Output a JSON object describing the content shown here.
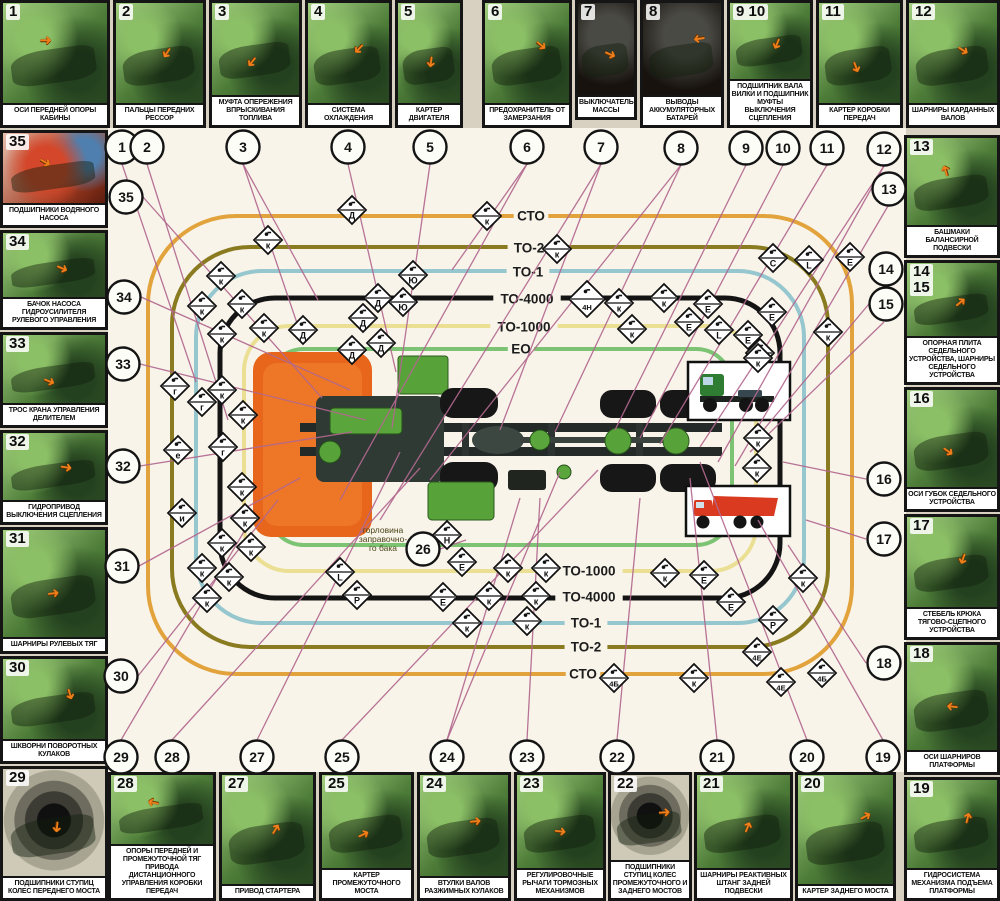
{
  "chart_title": "",
  "colors": {
    "page_bg": "#d8d0c0",
    "field_bg": "#f8f4ea",
    "line": "#b2688e",
    "ring_sto": "#e2a33c",
    "ring_to2": "#8a7b20",
    "ring_to1": "#96c6ce",
    "ring_to4000": "#141414",
    "ring_to1000": "#eadf92",
    "ring_eo": "#7cc474",
    "cab_orange": "#e8661c",
    "part_green": "#57a33a",
    "arrow_orange": "#ef7f1a"
  },
  "panels": {
    "top": [
      {
        "n": "1",
        "x": 0,
        "y": 0,
        "w": 110,
        "h": 128,
        "cap": "ОСИ ПЕРЕДНЕЙ ОПОРЫ КАБИНЫ",
        "v": "green"
      },
      {
        "n": "2",
        "x": 113,
        "y": 0,
        "w": 93,
        "h": 128,
        "cap": "ПАЛЬЦЫ ПЕРЕДНИХ РЕССОР",
        "v": "green"
      },
      {
        "n": "3",
        "x": 209,
        "y": 0,
        "w": 93,
        "h": 128,
        "cap": "МУФТА ОПЕРЕЖЕНИЯ ВПРЫСКИВАНИЯ ТОПЛИВА",
        "v": "green"
      },
      {
        "n": "4",
        "x": 305,
        "y": 0,
        "w": 87,
        "h": 128,
        "cap": "СИСТЕМА ОХЛАЖДЕНИЯ",
        "v": "green"
      },
      {
        "n": "5",
        "x": 395,
        "y": 0,
        "w": 68,
        "h": 128,
        "cap": "КАРТЕР ДВИГАТЕЛЯ",
        "v": "green"
      },
      {
        "n": "6",
        "x": 482,
        "y": 0,
        "w": 90,
        "h": 128,
        "cap": "ПРЕДОХРАНИТЕЛЬ ОТ ЗАМЕРЗАНИЯ",
        "v": "green"
      },
      {
        "n": "7",
        "x": 575,
        "y": 0,
        "w": 62,
        "h": 120,
        "cap": "ВЫКЛЮЧАТЕЛЬ МАССЫ",
        "v": "dark"
      },
      {
        "n": "8",
        "x": 640,
        "y": 0,
        "w": 84,
        "h": 128,
        "cap": "ВЫВОДЫ АККУМУЛЯТОРНЫХ БАТАРЕЙ",
        "v": "dark"
      },
      {
        "n": "9 10",
        "x": 727,
        "y": 0,
        "w": 86,
        "h": 128,
        "cap": "ПОДШИПНИК ВАЛА ВИЛКИ И ПОДШИПНИК МУФТЫ ВЫКЛЮЧЕНИЯ СЦЕПЛЕНИЯ",
        "v": "green"
      },
      {
        "n": "11",
        "x": 816,
        "y": 0,
        "w": 87,
        "h": 128,
        "cap": "КАРТЕР КОРОБКИ ПЕРЕДАЧ",
        "v": "green"
      },
      {
        "n": "12",
        "x": 906,
        "y": 0,
        "w": 94,
        "h": 128,
        "cap": "ШАРНИРЫ КАРДАННЫХ ВАЛОВ",
        "v": "green"
      }
    ],
    "left": [
      {
        "n": "35",
        "x": 0,
        "y": 130,
        "w": 108,
        "h": 98,
        "cap": "ПОДШИПНИКИ ВОДЯНОГО НАСОСА",
        "v": "red"
      },
      {
        "n": "34",
        "x": 0,
        "y": 230,
        "w": 108,
        "h": 100,
        "cap": "БАЧОК НАСОСА ГИДРОУСИЛИТЕЛЯ РУЛЕВОГО УПРАВЛЕНИЯ",
        "v": "green"
      },
      {
        "n": "33",
        "x": 0,
        "y": 332,
        "w": 108,
        "h": 96,
        "cap": "ТРОС КРАНА УПРАВЛЕНИЯ ДЕЛИТЕЛЕМ",
        "v": "green"
      },
      {
        "n": "32",
        "x": 0,
        "y": 430,
        "w": 108,
        "h": 95,
        "cap": "ГИДРОПРИВОД ВЫКЛЮЧЕНИЯ СЦЕПЛЕНИЯ",
        "v": "green"
      },
      {
        "n": "31",
        "x": 0,
        "y": 527,
        "w": 108,
        "h": 127,
        "cap": "ШАРНИРЫ РУЛЕВЫХ ТЯГ",
        "v": "green"
      },
      {
        "n": "30",
        "x": 0,
        "y": 656,
        "w": 108,
        "h": 108,
        "cap": "ШКВОРНИ ПОВОРОТНЫХ КУЛАКОВ",
        "v": "green"
      },
      {
        "n": "29",
        "x": 0,
        "y": 766,
        "w": 108,
        "h": 135,
        "cap": "ПОДШИПНИКИ СТУПИЦ КОЛЕС ПЕРЕДНЕГО МОСТА",
        "v": "wheel"
      }
    ],
    "right": [
      {
        "n": "13",
        "x": 904,
        "y": 135,
        "w": 96,
        "h": 123,
        "cap": "БАШМАКИ БАЛАНСИРНОЙ ПОДВЕСКИ",
        "v": "green"
      },
      {
        "n": "14\n15",
        "x": 904,
        "y": 260,
        "w": 96,
        "h": 125,
        "cap": "ОПОРНАЯ ПЛИТА СЕДЕЛЬНОГО УСТРОЙСТВА, ШАРНИРЫ СЕДЕЛЬНОГО УСТРОЙСТВА",
        "v": "green"
      },
      {
        "n": "16",
        "x": 904,
        "y": 387,
        "w": 96,
        "h": 125,
        "cap": "ОСИ ГУБОК СЕДЕЛЬНОГО УСТРОЙСТВА",
        "v": "green"
      },
      {
        "n": "17",
        "x": 904,
        "y": 514,
        "w": 96,
        "h": 126,
        "cap": "СТЕБЕЛЬ КРЮКА ТЯГОВО-СЦЕПНОГО УСТРОЙСТВА",
        "v": "green"
      },
      {
        "n": "18",
        "x": 904,
        "y": 642,
        "w": 96,
        "h": 133,
        "cap": "ОСИ ШАРНИРОВ ПЛАТФОРМЫ",
        "v": "green"
      },
      {
        "n": "19",
        "x": 904,
        "y": 777,
        "w": 96,
        "h": 124,
        "cap": "ГИДРОСИСТЕМА МЕХАНИЗМА ПОДЪЕМА ПЛАТФОРМЫ",
        "v": "green"
      }
    ],
    "bottom": [
      {
        "n": "28",
        "x": 108,
        "y": 772,
        "w": 108,
        "h": 129,
        "cap": "ОПОРЫ ПЕРЕДНЕЙ И ПРОМЕЖУТОЧНОЙ ТЯГ ПРИВОДА ДИСТАНЦИОННОГО УПРАВЛЕНИЯ КОРОБКИ ПЕРЕДАЧ",
        "v": "green"
      },
      {
        "n": "27",
        "x": 219,
        "y": 772,
        "w": 97,
        "h": 129,
        "cap": "ПРИВОД СТАРТЕРА",
        "v": "green"
      },
      {
        "n": "25",
        "x": 319,
        "y": 772,
        "w": 95,
        "h": 129,
        "cap": "КАРТЕР ПРОМЕЖУТОЧНОГО МОСТА",
        "v": "green"
      },
      {
        "n": "24",
        "x": 417,
        "y": 772,
        "w": 94,
        "h": 129,
        "cap": "ВТУЛКИ ВАЛОВ РАЗЖИМНЫХ КУЛАКОВ",
        "v": "green"
      },
      {
        "n": "23",
        "x": 514,
        "y": 772,
        "w": 92,
        "h": 129,
        "cap": "РЕГУЛИРОВОЧНЫЕ РЫЧАГИ ТОРМОЗНЫХ МЕХАНИЗМОВ",
        "v": "green"
      },
      {
        "n": "22",
        "x": 608,
        "y": 772,
        "w": 84,
        "h": 129,
        "cap": "ПОДШИПНИКИ СТУПИЦ КОЛЕС ПРОМЕЖУТОЧНОГО И ЗАДНЕГО МОСТОВ",
        "v": "wheel"
      },
      {
        "n": "21",
        "x": 694,
        "y": 772,
        "w": 99,
        "h": 129,
        "cap": "ШАРНИРЫ РЕАКТИВНЫХ ШТАНГ ЗАДНЕЙ ПОДВЕСКИ",
        "v": "green"
      },
      {
        "n": "20",
        "x": 795,
        "y": 772,
        "w": 101,
        "h": 129,
        "cap": "КАРТЕР ЗАДНЕГО МОСТА",
        "v": "green"
      }
    ]
  },
  "rings": [
    {
      "label": "СТО",
      "x": 148,
      "y": 216,
      "w": 704,
      "h": 458,
      "rx": 88,
      "sw": 4,
      "color": "#e2a33c"
    },
    {
      "label": "ТО-2",
      "x": 172,
      "y": 247,
      "w": 656,
      "h": 400,
      "rx": 78,
      "sw": 4,
      "color": "#8a7b20"
    },
    {
      "label": "ТО-1",
      "x": 196,
      "y": 271,
      "w": 608,
      "h": 352,
      "rx": 66,
      "sw": 4,
      "color": "#96c6ce"
    },
    {
      "label": "ТО-4000",
      "x": 220,
      "y": 298,
      "w": 560,
      "h": 300,
      "rx": 55,
      "sw": 5,
      "color": "#141414"
    },
    {
      "label": "ТО-1000",
      "x": 244,
      "y": 326,
      "w": 512,
      "h": 245,
      "rx": 45,
      "sw": 4,
      "color": "#eadf92"
    },
    {
      "label": "ЕО",
      "x": 268,
      "y": 349,
      "w": 464,
      "h": 196,
      "rx": 36,
      "sw": 4,
      "color": "#7cc474"
    }
  ],
  "ring_labels": {
    "top": [
      {
        "text": "СТО",
        "x": 531,
        "y": 216
      },
      {
        "text": "ТО-2",
        "x": 529,
        "y": 248
      },
      {
        "text": "ТО-1",
        "x": 528,
        "y": 272
      },
      {
        "text": "ТО-4000",
        "x": 527,
        "y": 299
      },
      {
        "text": "ТО-1000",
        "x": 524,
        "y": 327
      },
      {
        "text": "ЕО",
        "x": 521,
        "y": 349
      }
    ],
    "bottom": [
      {
        "text": "ТО-1000",
        "x": 589,
        "y": 571
      },
      {
        "text": "ТО-4000",
        "x": 589,
        "y": 597
      },
      {
        "text": "ТО-1",
        "x": 586,
        "y": 623
      },
      {
        "text": "ТО-2",
        "x": 586,
        "y": 647
      },
      {
        "text": "СТО",
        "x": 583,
        "y": 674
      }
    ]
  },
  "center_note": {
    "lines": [
      "горловина",
      "заправочно-",
      "го бака"
    ],
    "x": 383,
    "y": 533
  },
  "circles": [
    [
      "1",
      122,
      147
    ],
    [
      "2",
      147,
      147
    ],
    [
      "3",
      243,
      147
    ],
    [
      "4",
      348,
      147
    ],
    [
      "5",
      430,
      147
    ],
    [
      "6",
      527,
      147
    ],
    [
      "7",
      601,
      147
    ],
    [
      "8",
      681,
      148
    ],
    [
      "9",
      746,
      148
    ],
    [
      "10",
      783,
      148
    ],
    [
      "11",
      827,
      148
    ],
    [
      "12",
      884,
      149
    ],
    [
      "13",
      889,
      189
    ],
    [
      "14",
      886,
      269
    ],
    [
      "15",
      886,
      304
    ],
    [
      "16",
      884,
      479
    ],
    [
      "17",
      884,
      539
    ],
    [
      "18",
      884,
      663
    ],
    [
      "35",
      126,
      197
    ],
    [
      "34",
      124,
      297
    ],
    [
      "33",
      123,
      364
    ],
    [
      "32",
      123,
      466
    ],
    [
      "31",
      122,
      566
    ],
    [
      "30",
      121,
      676
    ],
    [
      "29",
      121,
      757
    ],
    [
      "28",
      172,
      757
    ],
    [
      "27",
      257,
      757
    ],
    [
      "25",
      342,
      757
    ],
    [
      "24",
      447,
      757
    ],
    [
      "23",
      527,
      757
    ],
    [
      "22",
      617,
      757
    ],
    [
      "21",
      717,
      757
    ],
    [
      "20",
      807,
      757
    ],
    [
      "19",
      883,
      757
    ],
    [
      "26",
      423,
      549
    ]
  ],
  "diamonds": [
    [
      487,
      216,
      "к"
    ],
    [
      557,
      249,
      "к"
    ],
    [
      352,
      210,
      "Д"
    ],
    [
      268,
      240,
      "к"
    ],
    [
      221,
      276,
      "к"
    ],
    [
      202,
      306,
      "к"
    ],
    [
      242,
      304,
      "к"
    ],
    [
      222,
      334,
      "к"
    ],
    [
      264,
      328,
      "к"
    ],
    [
      303,
      330,
      "Д"
    ],
    [
      363,
      318,
      "Д"
    ],
    [
      352,
      350,
      "Д"
    ],
    [
      378,
      298,
      "Д"
    ],
    [
      381,
      343,
      "Д"
    ],
    [
      413,
      275,
      "Ю"
    ],
    [
      403,
      302,
      "Ю"
    ],
    [
      587,
      299,
      "4Н",
      18
    ],
    [
      619,
      303,
      "к"
    ],
    [
      664,
      298,
      "к"
    ],
    [
      708,
      304,
      "Е"
    ],
    [
      632,
      329,
      "к"
    ],
    [
      689,
      322,
      "Е"
    ],
    [
      719,
      330,
      "L"
    ],
    [
      748,
      335,
      "Е"
    ],
    [
      772,
      312,
      "Е"
    ],
    [
      760,
      353,
      "к"
    ],
    [
      828,
      332,
      "к"
    ],
    [
      773,
      258,
      "С"
    ],
    [
      809,
      260,
      "L"
    ],
    [
      850,
      257,
      "Е"
    ],
    [
      175,
      386,
      "г"
    ],
    [
      222,
      390,
      "к"
    ],
    [
      202,
      402,
      "г"
    ],
    [
      243,
      415,
      "к"
    ],
    [
      178,
      450,
      "е"
    ],
    [
      223,
      447,
      "г"
    ],
    [
      182,
      513,
      "и"
    ],
    [
      242,
      487,
      "к"
    ],
    [
      245,
      518,
      "к"
    ],
    [
      222,
      543,
      "к"
    ],
    [
      251,
      547,
      "к"
    ],
    [
      202,
      568,
      "к"
    ],
    [
      229,
      577,
      "к"
    ],
    [
      207,
      598,
      "к"
    ],
    [
      340,
      572,
      "L"
    ],
    [
      357,
      595,
      "Р"
    ],
    [
      447,
      535,
      "Н"
    ],
    [
      462,
      562,
      "Е"
    ],
    [
      508,
      568,
      "к"
    ],
    [
      546,
      568,
      "к"
    ],
    [
      443,
      597,
      "Е"
    ],
    [
      489,
      596,
      "к"
    ],
    [
      536,
      596,
      "к"
    ],
    [
      467,
      623,
      "к"
    ],
    [
      527,
      621,
      "к"
    ],
    [
      758,
      358,
      "к"
    ],
    [
      758,
      438,
      "к"
    ],
    [
      757,
      468,
      "к"
    ],
    [
      665,
      573,
      "к"
    ],
    [
      704,
      575,
      "Е"
    ],
    [
      731,
      602,
      "Е"
    ],
    [
      803,
      578,
      "к"
    ],
    [
      773,
      620,
      "Р"
    ],
    [
      757,
      652,
      "4Е"
    ],
    [
      694,
      678,
      "к"
    ],
    [
      781,
      682,
      "4Е"
    ],
    [
      822,
      673,
      "4Б"
    ],
    [
      614,
      678,
      "4Б"
    ]
  ],
  "lines": [
    [
      122,
      164,
      196,
      382
    ],
    [
      147,
      164,
      228,
      420
    ],
    [
      243,
      164,
      318,
      300
    ],
    [
      243,
      164,
      300,
      332
    ],
    [
      348,
      164,
      396,
      372
    ],
    [
      430,
      164,
      392,
      428
    ],
    [
      527,
      164,
      452,
      270
    ],
    [
      527,
      164,
      340,
      500
    ],
    [
      601,
      164,
      500,
      430
    ],
    [
      601,
      164,
      380,
      520
    ],
    [
      681,
      165,
      555,
      432
    ],
    [
      681,
      165,
      430,
      480
    ],
    [
      746,
      165,
      615,
      430
    ],
    [
      783,
      165,
      640,
      438
    ],
    [
      827,
      165,
      660,
      444
    ],
    [
      884,
      166,
      700,
      447
    ],
    [
      884,
      166,
      718,
      462
    ],
    [
      888,
      206,
      735,
      466
    ],
    [
      884,
      286,
      755,
      440
    ],
    [
      884,
      322,
      750,
      452
    ],
    [
      866,
      479,
      783,
      462
    ],
    [
      866,
      539,
      806,
      520
    ],
    [
      866,
      663,
      788,
      545
    ],
    [
      143,
      197,
      322,
      398
    ],
    [
      141,
      297,
      350,
      390
    ],
    [
      140,
      364,
      366,
      420
    ],
    [
      140,
      466,
      352,
      432
    ],
    [
      139,
      566,
      300,
      478
    ],
    [
      138,
      676,
      278,
      500
    ],
    [
      121,
      740,
      252,
      518
    ],
    [
      172,
      740,
      420,
      468
    ],
    [
      257,
      740,
      400,
      452
    ],
    [
      342,
      740,
      598,
      470
    ],
    [
      447,
      740,
      520,
      498
    ],
    [
      447,
      740,
      560,
      472
    ],
    [
      527,
      740,
      540,
      498
    ],
    [
      617,
      740,
      640,
      498
    ],
    [
      717,
      740,
      690,
      478
    ],
    [
      807,
      740,
      700,
      462
    ],
    [
      883,
      740,
      758,
      520
    ],
    [
      440,
      549,
      466,
      540
    ]
  ],
  "insets": [
    {
      "kind": "tractor-truck",
      "x": 688,
      "y": 362,
      "w": 102,
      "h": 58
    },
    {
      "kind": "dump-truck",
      "x": 686,
      "y": 486,
      "w": 104,
      "h": 50
    }
  ]
}
